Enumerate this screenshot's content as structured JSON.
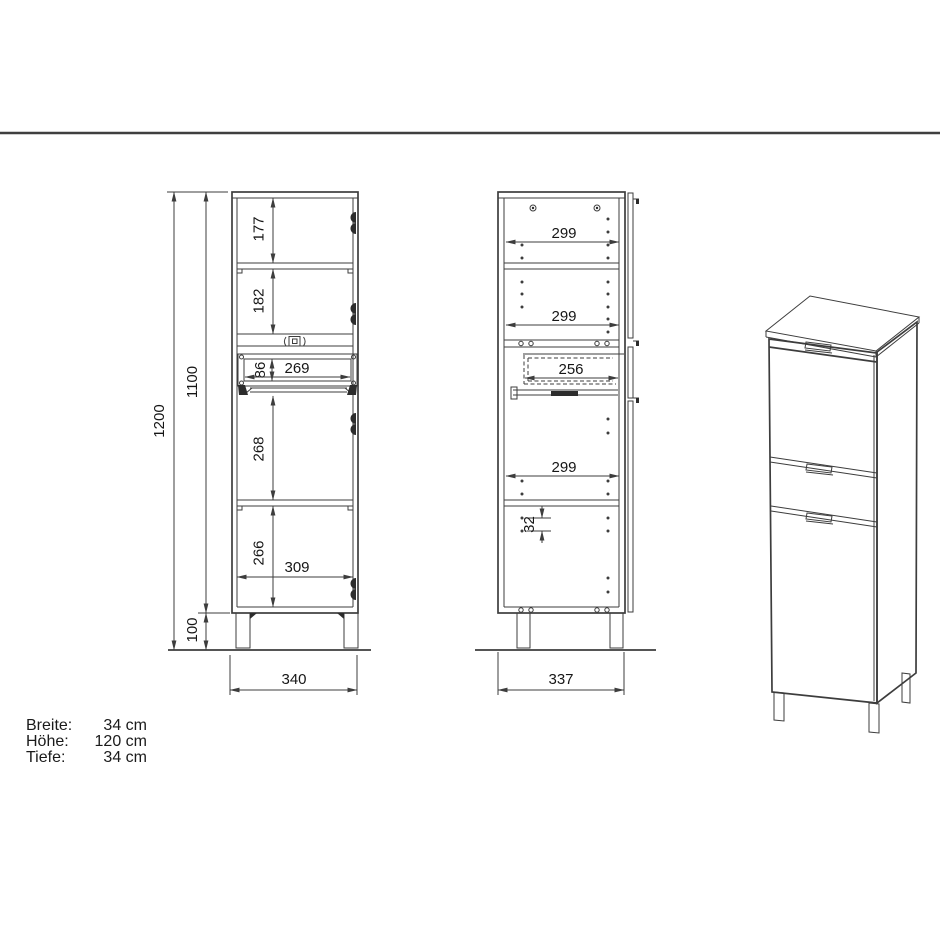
{
  "page": {
    "background": "#ffffff",
    "line_color": "#3d3d3d",
    "text_color": "#1b1b1b"
  },
  "specs": {
    "rows": [
      {
        "label": "Breite:",
        "value": "34 cm"
      },
      {
        "label": "Höhe:",
        "value": "120 cm"
      },
      {
        "label": "Tiefe:",
        "value": "34 cm"
      }
    ]
  },
  "front_view": {
    "dims": {
      "overall_height": "1200",
      "carcass_height": "1100",
      "leg_height": "100",
      "top_compartment": "177",
      "second_compartment": "182",
      "drawer_opening_height": "86",
      "drawer_opening_width": "269",
      "third_compartment": "268",
      "bottom_compartment": "266",
      "interior_width": "309",
      "overall_width": "340"
    }
  },
  "side_view": {
    "dims": {
      "top_shelf_depth": "299",
      "middle_shelf_depth": "299",
      "drawer_depth": "256",
      "lower_shelf_depth": "299",
      "shelf_hole_pitch": "32",
      "overall_depth": "337"
    }
  }
}
